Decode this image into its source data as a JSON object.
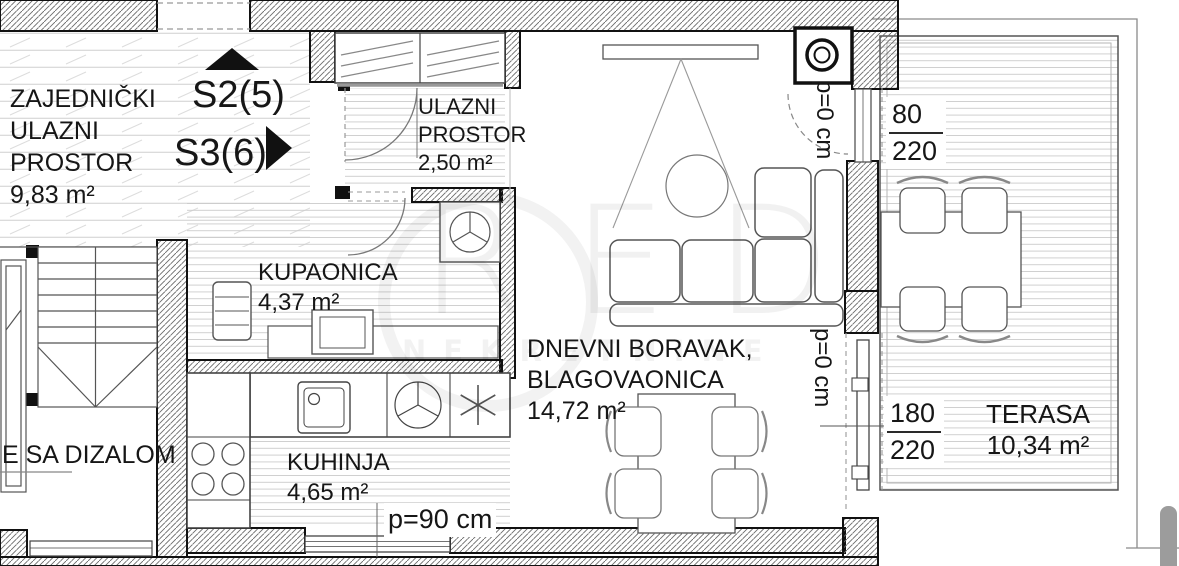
{
  "units": {
    "s2_label": "S2(5)",
    "s3_label": "S3(6)"
  },
  "rooms": {
    "common_entrance": {
      "line1": "ZAJEDNIČKI",
      "line2": "ULAZNI",
      "line3": "PROSTOR",
      "area": "9,83 m²"
    },
    "entry": {
      "line1": "ULAZNI",
      "line2": "PROSTOR",
      "area": "2,50 m²"
    },
    "bathroom": {
      "name": "KUPAONICA",
      "area": "4,37 m²"
    },
    "kitchen": {
      "name": "KUHINJA",
      "area": "4,65 m²"
    },
    "living_dining": {
      "line1": "DNEVNI BORAVAK,",
      "line2": "BLAGOVAONICA",
      "area": "14,72 m²"
    },
    "terrace": {
      "name": "TERASA",
      "area": "10,34 m²"
    },
    "staircase": {
      "label": "E SA DIZALOM"
    }
  },
  "dimensions": {
    "terrace_door": {
      "top": "80",
      "bottom": "220"
    },
    "terrace_slider": {
      "top": "180",
      "bottom": "220"
    },
    "parapet_door_top": "p=0 cm",
    "parapet_slider": "p=0 cm",
    "parapet_kitchen_window": "p=90 cm"
  },
  "watermark": {
    "letters": [
      "R",
      "E",
      "D"
    ],
    "subtitle": "NEKRETNINE"
  },
  "colors": {
    "wall_line": "#111111",
    "drawing_line": "#555555",
    "floor_line": "#cccccc",
    "pillar": "#9c9c9c",
    "watermark": "rgba(0,0,0,0.055)"
  }
}
